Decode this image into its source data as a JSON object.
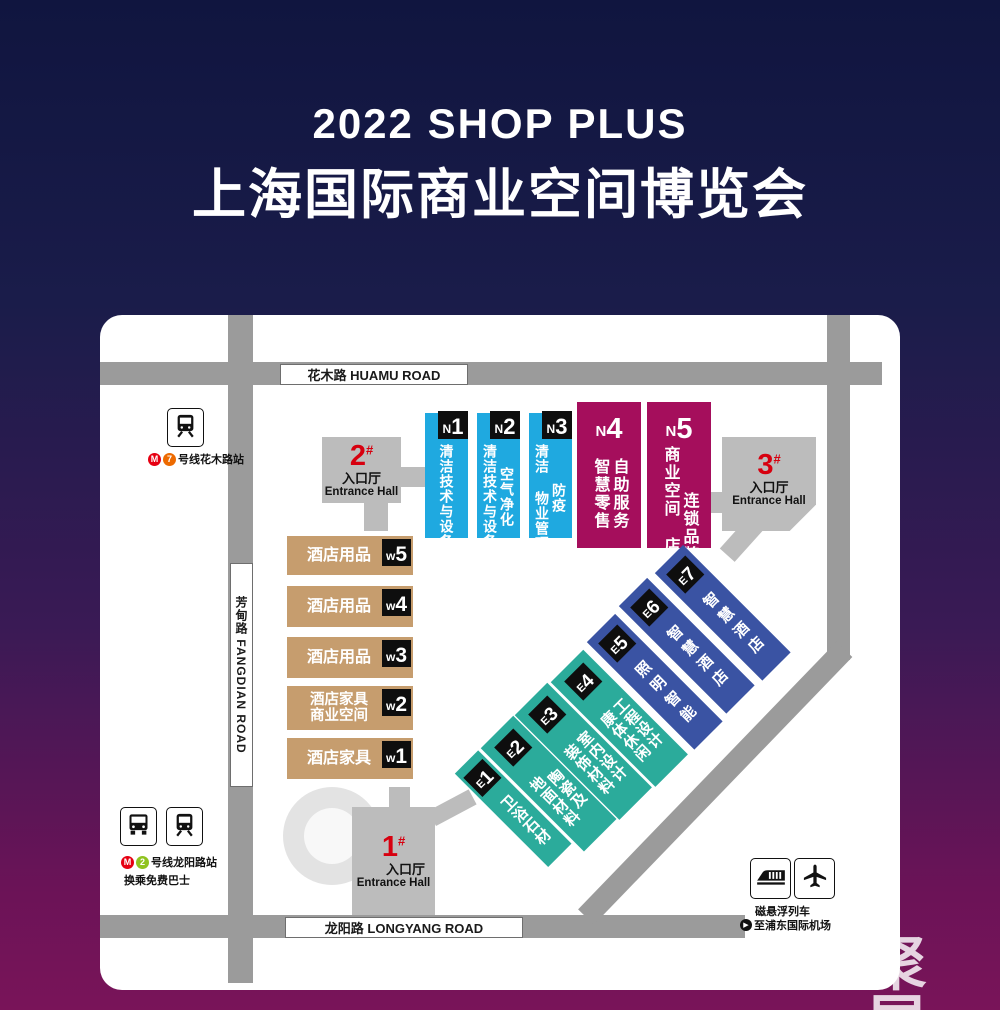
{
  "title": {
    "line1": "2022 SHOP PLUS",
    "line2": "上海国际商业空间博览会"
  },
  "watermark": "聚展",
  "colors": {
    "background_top": "#10153f",
    "background_bottom": "#791459",
    "road_gray": "#9b9b9b",
    "entrance_gray": "#bcbcbc",
    "north_blue": "#1fa9e0",
    "north_magenta": "#a50e5c",
    "west_tan": "#c69d6e",
    "east_teal": "#2bab9b",
    "east_indigo": "#3a53a3",
    "label_black": "#0e0e0e",
    "entrance_red": "#d7000f",
    "metro_red": "#e60012",
    "line7_orange": "#ed6a00",
    "line2_green": "#8fc31f"
  },
  "roads": {
    "huamu": "花木路  HUAMU ROAD",
    "fangdian": "芳甸路 FANGDIAN ROAD",
    "longyang": "龙阳路  LONGYANG ROAD"
  },
  "entrances": {
    "hall1": {
      "num": "1",
      "hash": "#",
      "cn": "入口厅",
      "en": "Entrance Hall"
    },
    "hall2": {
      "num": "2",
      "hash": "#",
      "cn": "入口厅",
      "en": "Entrance Hall"
    },
    "hall3": {
      "num": "3",
      "hash": "#",
      "cn": "入口厅",
      "en": "Entrance Hall"
    }
  },
  "stations": {
    "huamu": {
      "metro_logo": "M",
      "badge": "7",
      "label": "号线花木路站"
    },
    "longyang": {
      "metro_logo": "M",
      "badge": "2",
      "label": "号线龙阳路站",
      "note": "换乘免费巴士"
    },
    "maglev": {
      "line1": "磁悬浮列车",
      "arrow": "▶",
      "line2": "至浦东国际机场"
    }
  },
  "icons": [
    "train-front-icon",
    "bus-icon",
    "maglev-train-icon",
    "airplane-icon",
    "metro-logo",
    "play-circle-icon"
  ],
  "halls": {
    "north": [
      {
        "letter": "N",
        "num": "1",
        "columns": [
          "清洁技术与设备"
        ]
      },
      {
        "letter": "N",
        "num": "2",
        "columns": [
          "空气净化",
          "清洁技术与设备"
        ]
      },
      {
        "letter": "N",
        "num": "3",
        "columns": [
          "防疫",
          "清洁 物业管理"
        ]
      },
      {
        "letter": "N",
        "num": "4",
        "columns": [
          "自助服务",
          "智慧零售"
        ]
      },
      {
        "letter": "N",
        "num": "5",
        "columns": [
          "连锁品牌",
          "商业空间 店铺陈列"
        ]
      }
    ],
    "west": [
      {
        "letter": "w",
        "num": "5",
        "lines": [
          "酒店用品"
        ]
      },
      {
        "letter": "w",
        "num": "4",
        "lines": [
          "酒店用品"
        ]
      },
      {
        "letter": "w",
        "num": "3",
        "lines": [
          "酒店用品"
        ]
      },
      {
        "letter": "w",
        "num": "2",
        "lines": [
          "酒店家具",
          "商业空间"
        ]
      },
      {
        "letter": "w",
        "num": "1",
        "lines": [
          "酒店家具"
        ]
      }
    ],
    "east": [
      {
        "letter": "E",
        "num": "1",
        "columns": [
          "卫浴石材"
        ]
      },
      {
        "letter": "E",
        "num": "2",
        "columns": [
          "陶瓷及",
          "地面材料"
        ]
      },
      {
        "letter": "E",
        "num": "3",
        "columns": [
          "室内设计",
          "装饰材料"
        ]
      },
      {
        "letter": "E",
        "num": "4",
        "columns": [
          "工程设计",
          "康体休闲"
        ]
      },
      {
        "letter": "E",
        "num": "5",
        "columns": [
          "照明智能"
        ]
      },
      {
        "letter": "E",
        "num": "6",
        "columns": [
          "智慧酒店"
        ]
      },
      {
        "letter": "E",
        "num": "7",
        "columns": [
          "智慧酒店"
        ]
      }
    ]
  }
}
